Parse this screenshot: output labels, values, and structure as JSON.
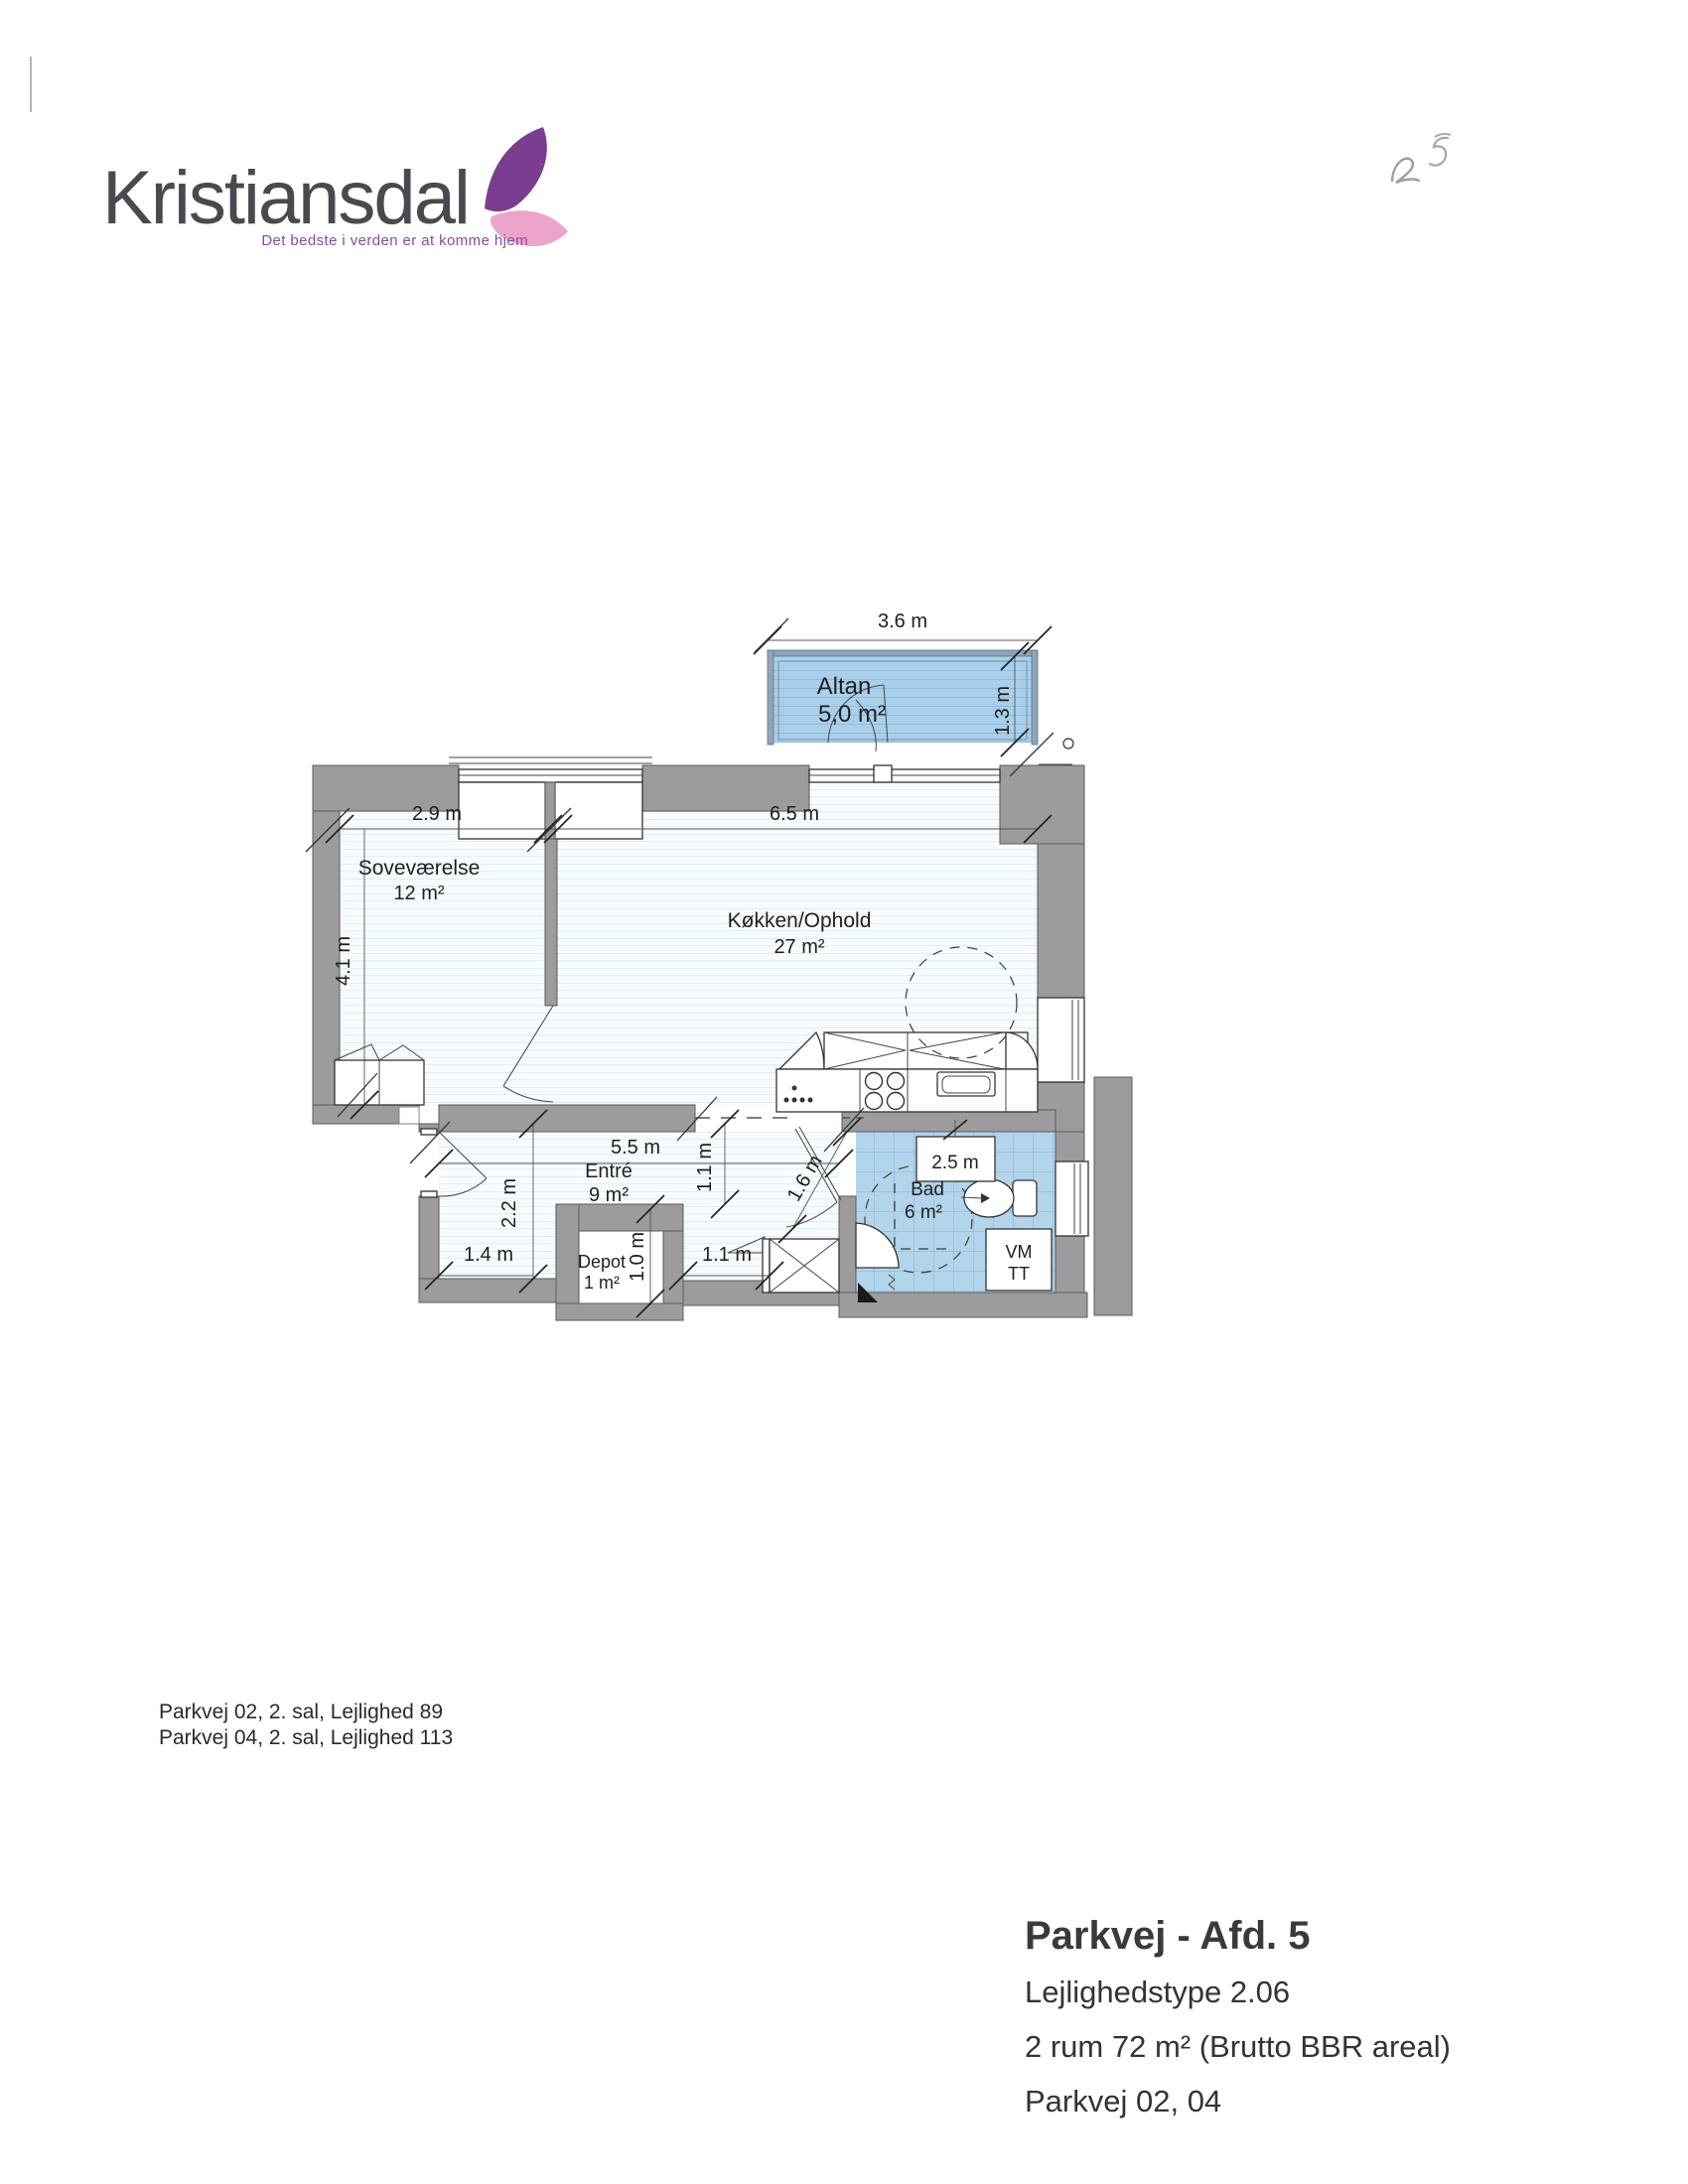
{
  "logo": {
    "wordmark": "Kristiansdal",
    "tagline": "Det bedste i verden er at komme hjem"
  },
  "handwritten_note": "25",
  "plan": {
    "rooms": {
      "altan": {
        "name": "Altan",
        "area": "5,0 m²"
      },
      "sovevaerelse": {
        "name": "Soveværelse",
        "area": "12 m²"
      },
      "koekken": {
        "name": "Køkken/Ophold",
        "area": "27 m²"
      },
      "entre": {
        "name": "Entré",
        "area": "9 m²"
      },
      "depot": {
        "name": "Depot",
        "area": "1 m²"
      },
      "bad": {
        "name": "Bad",
        "area": "6 m²"
      },
      "appliances": {
        "line1": "VM",
        "line2": "TT"
      }
    },
    "dimensions": {
      "balcony_width": "3.6 m",
      "balcony_depth": "1.3 m",
      "bedroom_width": "2.9 m",
      "bedroom_depth": "4.1 m",
      "living_width": "6.5 m",
      "entre_width": "5.5 m",
      "entre_passage": "1.1 m",
      "entre_depth": "2.2 m",
      "alcove_width": "1.4 m",
      "depot_depth": "1.0 m",
      "corridor_width": "1.1 m",
      "bath_door": "1.6 m",
      "bath_width": "2.5 m"
    }
  },
  "footer_left": {
    "line1": "Parkvej 02, 2. sal, Lejlighed 89",
    "line2": "Parkvej 04, 2. sal, Lejlighed 113"
  },
  "info_block": {
    "title": "Parkvej  - Afd. 5",
    "type_line": "Lejlighedstype 2.06",
    "size_line": "2 rum 72 m² (Brutto BBR areal)",
    "address_line": "Parkvej 02, 04"
  },
  "colors": {
    "brand_purple": "#7b3d8f",
    "brand_pink": "#e9a0c8",
    "tagline_purple": "#8a4b9c",
    "wall_gray": "#9c9c9e",
    "floor_stripe": "#cfe3ee",
    "water_blue": "#aed3ec"
  }
}
